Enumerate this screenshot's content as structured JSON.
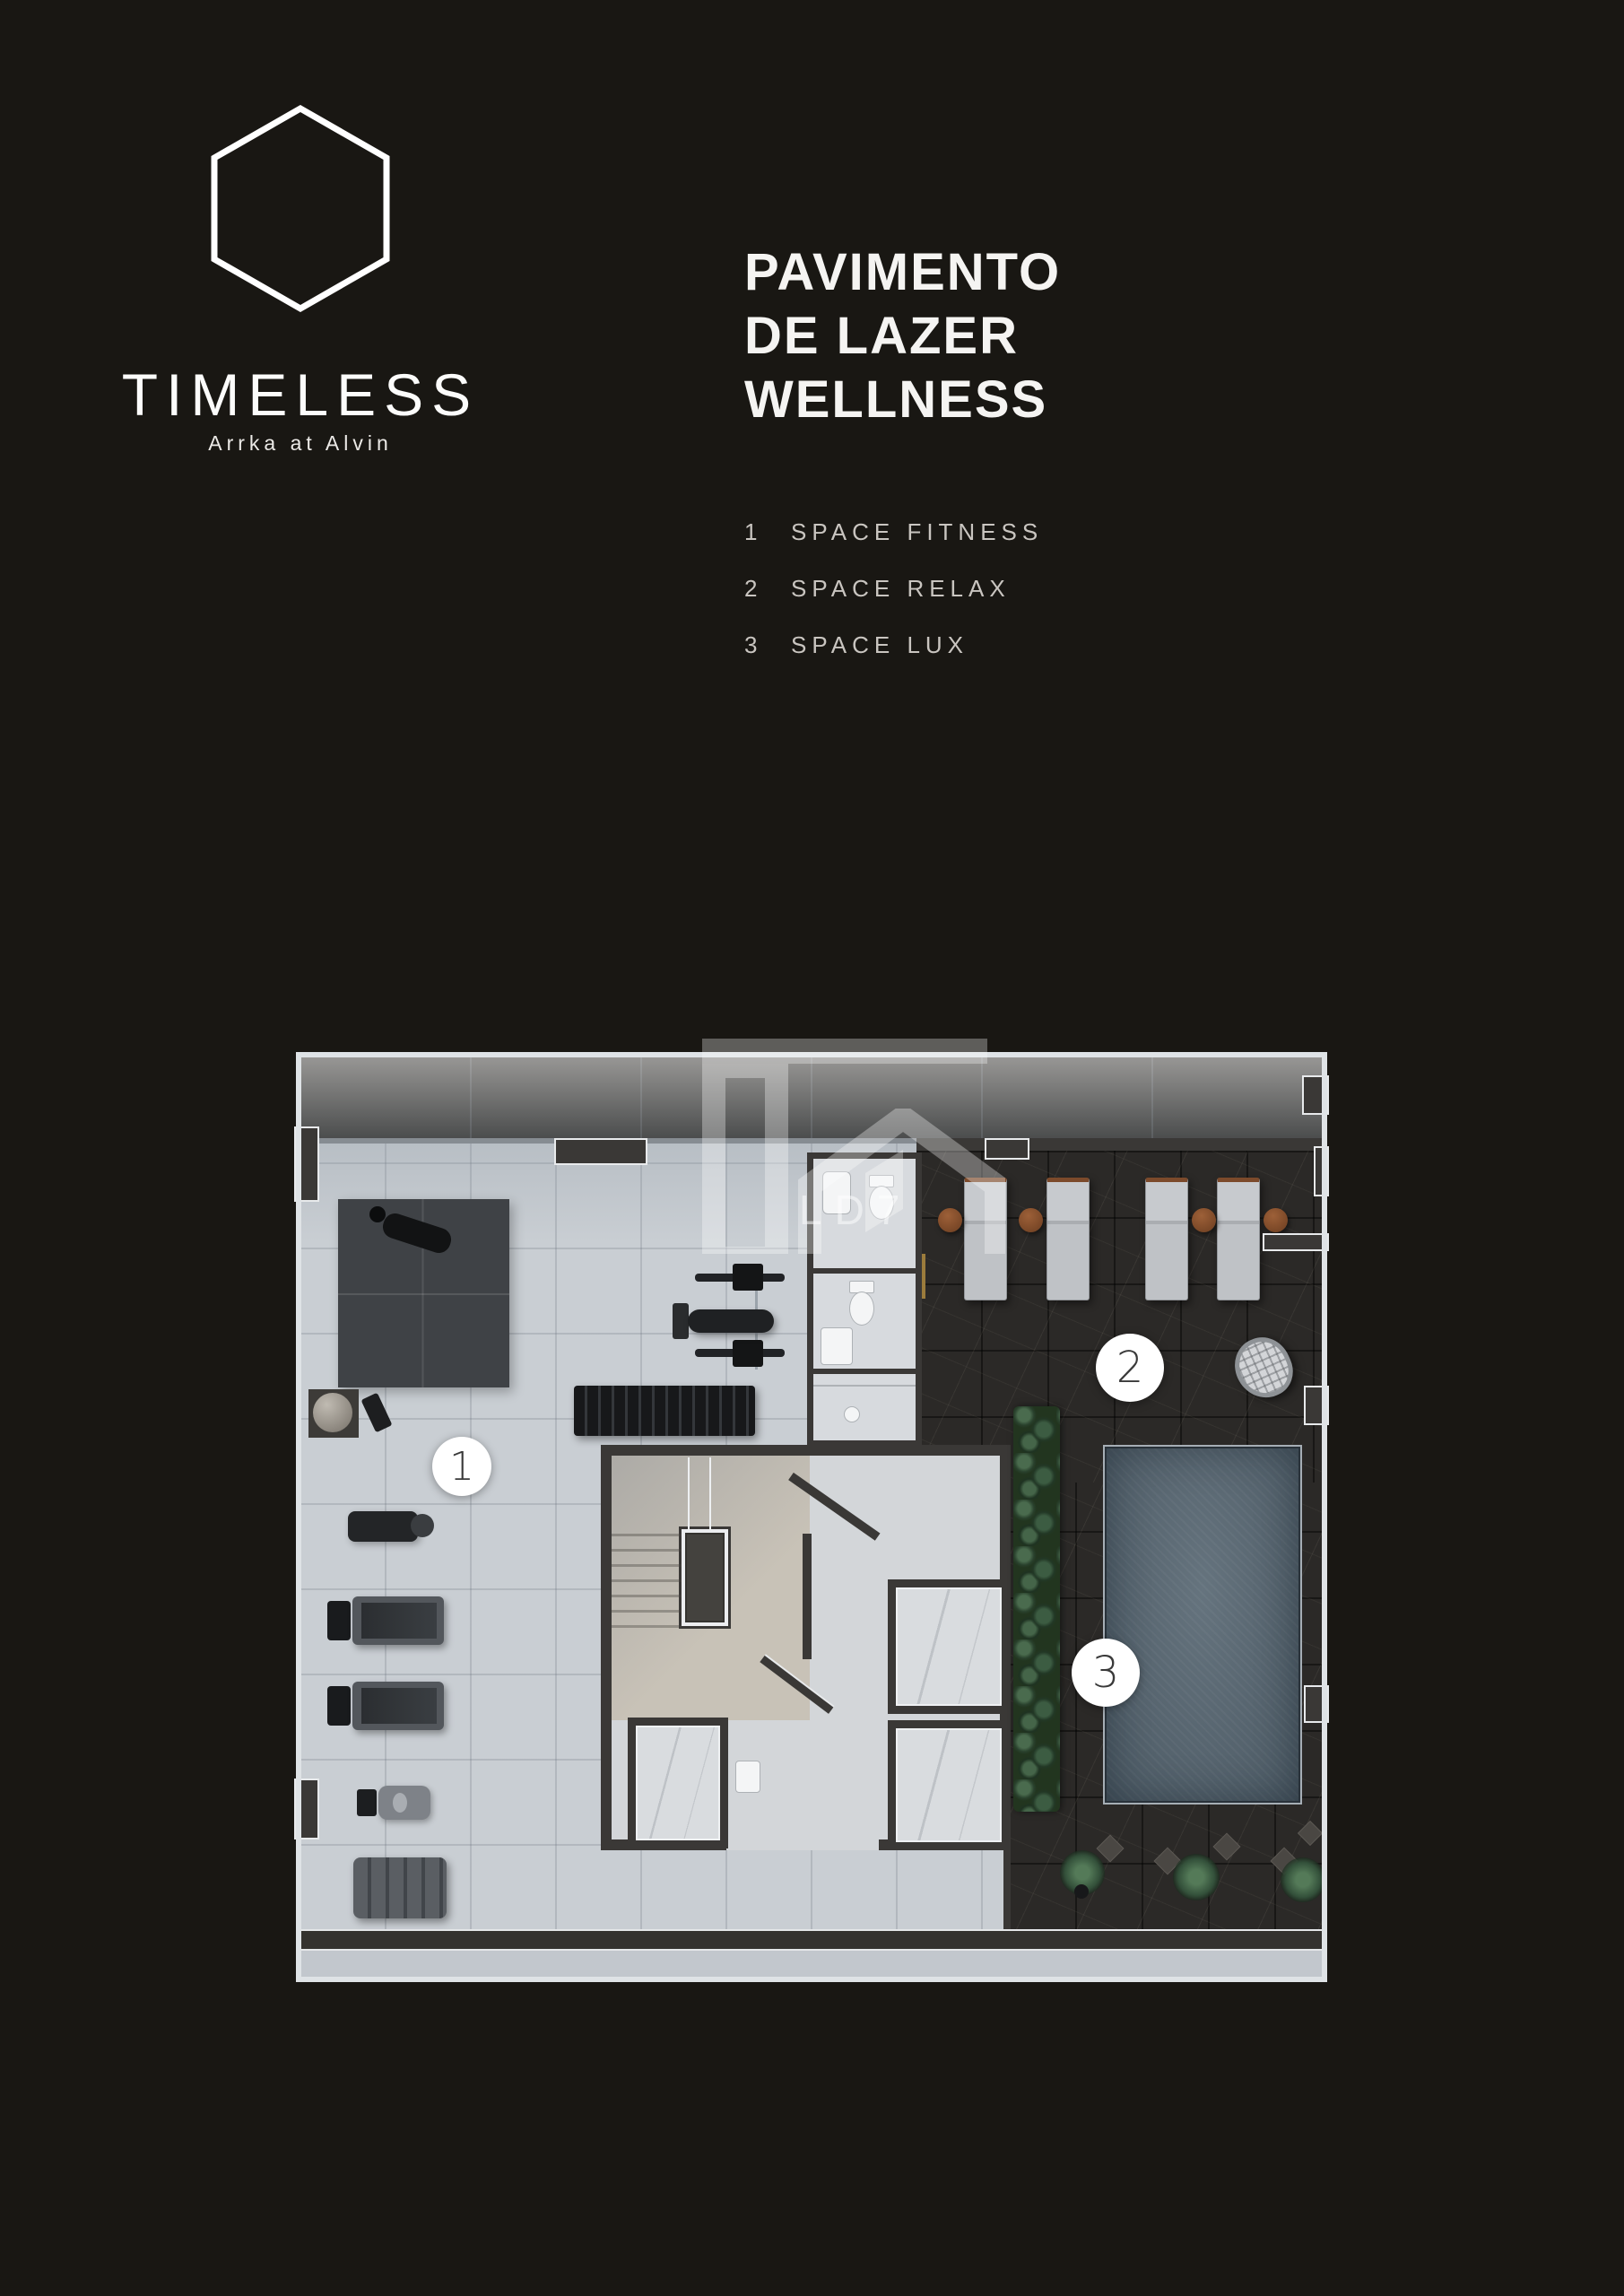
{
  "page": {
    "background": "#191713"
  },
  "brand": {
    "name": "TIMELESS",
    "tagline": "Arrka at Alvin",
    "mark": "hexagon-outline-icon"
  },
  "title": {
    "line1": "PAVIMENTO",
    "line2": "DE LAZER",
    "line3": "WELLNESS"
  },
  "legend": {
    "items": [
      {
        "number": "1",
        "label": "SPACE FITNESS"
      },
      {
        "number": "2",
        "label": "SPACE RELAX"
      },
      {
        "number": "3",
        "label": "SPACE LUX"
      }
    ]
  },
  "floorplan": {
    "watermark": "LD7",
    "markers": [
      {
        "number": "1",
        "area": "SPACE FITNESS"
      },
      {
        "number": "2",
        "area": "SPACE RELAX"
      },
      {
        "number": "3",
        "area": "SPACE LUX"
      }
    ],
    "palette": {
      "background": "#191713",
      "floor_light": "#c9ced3",
      "balcony_floor": "#dde1e5",
      "marble_dark": "#2b2927",
      "pool_water": "#5d6c77",
      "wall_dark": "#3a3836",
      "stair_concrete": "#c8c2b7",
      "wood_accent": "#8a5332",
      "hedge_green": "#3a543f",
      "marker_bg": "#ffffff",
      "text_white": "#f5f4f2",
      "text_gray": "#c9c5c0"
    }
  }
}
